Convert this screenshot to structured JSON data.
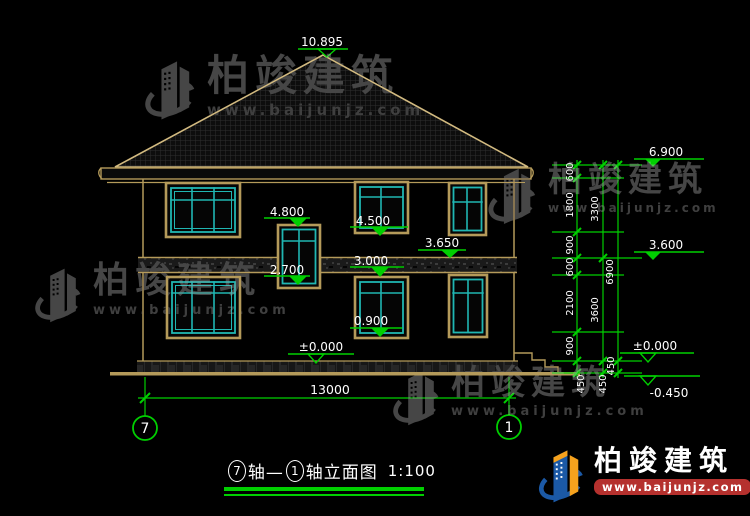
{
  "drawing": {
    "levels": {
      "ridge": "10.895",
      "eave_right": "6.900",
      "stair_top": "4.800",
      "win2f_sill": "4.500",
      "band_top": "3.650",
      "floor2_right": "3.600",
      "win1f_top": "3.000",
      "stair_bottom": "2.700",
      "win1f_sill": "0.900",
      "ground_left": "±0.000",
      "ground_right": "±0.000",
      "terrain": "-0.450"
    },
    "dims": {
      "chain1": [
        "600",
        "1800",
        "900",
        "600",
        "2100",
        "900",
        "450"
      ],
      "chain2": [
        "3300",
        "3600",
        "450"
      ],
      "chain3": [
        "6900",
        "450"
      ],
      "width": "13000"
    },
    "axis": {
      "left": "7",
      "right": "1"
    }
  },
  "title": {
    "axis_left": "7",
    "join": "轴—",
    "axis_right": "1",
    "rest": "轴立面图",
    "scale": "1:100"
  },
  "brand": {
    "name": "柏竣建筑",
    "url": "www.baijunjz.com"
  },
  "colors": {
    "background": "#000000",
    "dimension_green": "#00cf00",
    "wall_tan": "#b49a5a",
    "roof_outline": "#d2ba80",
    "window_cyan": "#20b6b2",
    "text_white": "#ffffff",
    "watermark_gray": "#464646",
    "logo_blue": "#1b59a6",
    "logo_orange": "#f6a21d",
    "logo_red": "#b5312e"
  }
}
